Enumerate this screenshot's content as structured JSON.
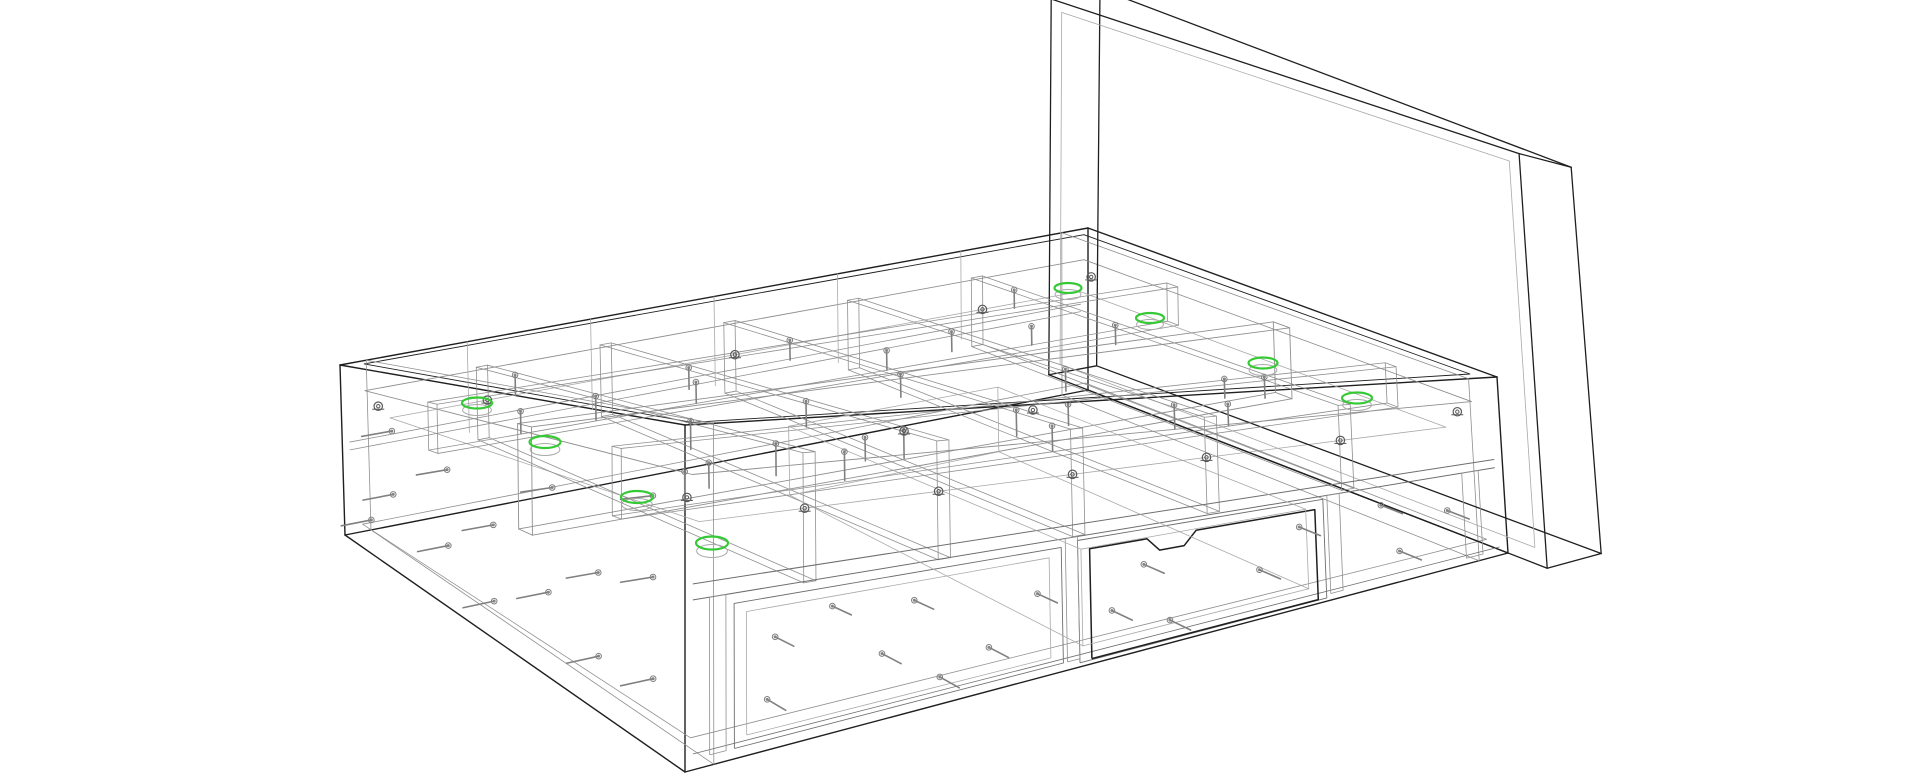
{
  "meta": {
    "title": "storage-bed-assembly-wireframe",
    "description": "CAD wireframe rendering of a platform storage bed with headboard, internal compartment grid, fasteners and one drawer front with handle notch; eight cam-lock positions highlighted in green",
    "background": "#ffffff"
  },
  "palette": {
    "outline_dark": "#1f1f1f",
    "line_mid": "#6e6e6e",
    "line_gray": "#8f8f8f",
    "line_light": "#a9a9a9",
    "fastener_gray": "#808080",
    "cam_gray": "#5a5a5a",
    "highlight_green": "#35c935",
    "highlight_shadow": "#a9a9a9"
  },
  "projection": {
    "L": 200,
    "W": 150,
    "H": 65,
    "lattice": {
      "T00": [
        685,
        425
      ],
      "T10": [
        1497,
        377
      ],
      "T01": [
        340,
        365
      ],
      "T11": [
        1088,
        228
      ],
      "B00": [
        685,
        772
      ],
      "B10": [
        1508,
        553
      ],
      "B01": [
        345,
        535
      ],
      "B11": [
        1088,
        390
      ]
    }
  },
  "parts": [
    {
      "name": "outer-frame",
      "type": "box",
      "color": "#1f1f1f",
      "lw": 1.4,
      "box": [
        0,
        200,
        0,
        150,
        0,
        65
      ]
    },
    {
      "name": "top-rim-inner",
      "type": "rect",
      "color": "#1f1f1f",
      "lw": 0.9,
      "plane": "z",
      "at": 65,
      "a": [
        4,
        196
      ],
      "b": [
        4,
        146
      ]
    },
    {
      "name": "top-rim-lip",
      "type": "rect",
      "color": "#8f8f8f",
      "lw": 0.9,
      "plane": "z",
      "at": 55,
      "a": [
        4,
        196
      ],
      "b": [
        4,
        146
      ]
    },
    {
      "name": "slat-ledge",
      "type": "rect",
      "color": "#a9a9a9",
      "lw": 0.8,
      "plane": "z",
      "at": 45,
      "a": [
        8,
        192
      ],
      "b": [
        8,
        142
      ]
    },
    {
      "name": "bottom-inner-rim",
      "type": "rect",
      "color": "#8f8f8f",
      "lw": 0.8,
      "plane": "z",
      "at": 5,
      "a": [
        3,
        197
      ],
      "b": [
        3,
        147
      ]
    },
    {
      "name": "left-end-inner-panel",
      "type": "rect",
      "color": "#8f8f8f",
      "lw": 0.8,
      "plane": "x",
      "at": 7,
      "a": [
        0,
        150
      ],
      "b": [
        0,
        65
      ]
    },
    {
      "name": "right-end-inner-panel",
      "type": "rect",
      "color": "#8f8f8f",
      "lw": 0.8,
      "plane": "x",
      "at": 193,
      "a": [
        0,
        150
      ],
      "b": [
        0,
        65
      ]
    },
    {
      "name": "headboard",
      "type": "box",
      "color": "#1f1f1f",
      "lw": 1.3,
      "box": [
        200,
        213,
        -14,
        164,
        0,
        152
      ]
    },
    {
      "name": "headboard-inner-face",
      "type": "rect",
      "color": "#a9a9a9",
      "lw": 0.8,
      "plane": "x",
      "at": 200,
      "a": [
        -10,
        160
      ],
      "b": [
        6,
        148
      ]
    },
    {
      "name": "center-beam",
      "type": "box",
      "color": "#8f8f8f",
      "lw": 0.9,
      "box": [
        3,
        197,
        72,
        78,
        30,
        57
      ]
    },
    {
      "name": "front-inner-rail",
      "type": "box",
      "color": "#8f8f8f",
      "lw": 0.8,
      "box": [
        3,
        197,
        33,
        37,
        42,
        57
      ]
    },
    {
      "name": "rear-inner-rail",
      "type": "box",
      "color": "#8f8f8f",
      "lw": 0.8,
      "box": [
        3,
        197,
        113,
        117,
        42,
        57
      ]
    },
    {
      "name": "cross-rib-1",
      "type": "box",
      "color": "#8f8f8f",
      "lw": 0.8,
      "box": [
        32.5,
        35.5,
        6,
        144,
        30,
        57
      ]
    },
    {
      "name": "cross-rib-2",
      "type": "box",
      "color": "#8f8f8f",
      "lw": 0.8,
      "box": [
        65.5,
        68.5,
        6,
        144,
        30,
        57
      ]
    },
    {
      "name": "cross-rib-3",
      "type": "box",
      "color": "#8f8f8f",
      "lw": 0.8,
      "box": [
        98.5,
        101.5,
        6,
        144,
        30,
        57
      ]
    },
    {
      "name": "cross-rib-4",
      "type": "box",
      "color": "#8f8f8f",
      "lw": 0.8,
      "box": [
        131.5,
        134.5,
        6,
        144,
        30,
        57
      ]
    },
    {
      "name": "cross-rib-5",
      "type": "box",
      "color": "#8f8f8f",
      "lw": 0.8,
      "box": [
        164.5,
        167.5,
        6,
        144,
        30,
        57
      ]
    },
    {
      "name": "front-mid-rail-top",
      "type": "line",
      "color": "#6e6e6e",
      "lw": 1.0,
      "line": [
        2,
        0,
        35,
        198,
        0,
        35
      ]
    },
    {
      "name": "front-mid-rail-bottom",
      "type": "line",
      "color": "#6e6e6e",
      "lw": 1.0,
      "line": [
        2,
        0,
        32,
        198,
        0,
        32
      ]
    },
    {
      "name": "rear-mid-rail-top",
      "type": "line",
      "color": "#8f8f8f",
      "lw": 0.8,
      "line": [
        2,
        150,
        35,
        198,
        150,
        35
      ]
    },
    {
      "name": "rear-mid-rail-bottom",
      "type": "line",
      "color": "#8f8f8f",
      "lw": 0.8,
      "line": [
        2,
        150,
        32,
        198,
        150,
        32
      ]
    },
    {
      "name": "front-kick-line",
      "type": "line",
      "color": "#6e6e6e",
      "lw": 0.8,
      "line": [
        2,
        0,
        3,
        198,
        0,
        3
      ]
    },
    {
      "name": "left-drawer-bay",
      "type": "rect",
      "color": "#6e6e6e",
      "lw": 0.9,
      "plane": "y",
      "at": 0,
      "a": [
        12,
        92
      ],
      "b": [
        2,
        30
      ]
    },
    {
      "name": "left-drawer-bay-inner",
      "type": "rect",
      "color": "#a9a9a9",
      "lw": 0.8,
      "plane": "y",
      "at": 0,
      "a": [
        15,
        89
      ],
      "b": [
        4,
        28
      ]
    },
    {
      "name": "right-drawer-opening",
      "type": "rect",
      "color": "#6e6e6e",
      "lw": 0.9,
      "plane": "y",
      "at": 0,
      "a": [
        96,
        156
      ],
      "b": [
        1,
        31
      ]
    },
    {
      "name": "front-stile-left",
      "type": "rect",
      "color": "#8f8f8f",
      "lw": 0.8,
      "plane": "y",
      "at": 0,
      "a": [
        6,
        10
      ],
      "b": [
        2,
        32
      ]
    },
    {
      "name": "front-stile-mid1",
      "type": "rect",
      "color": "#8f8f8f",
      "lw": 0.8,
      "plane": "y",
      "at": 0,
      "a": [
        93,
        96
      ],
      "b": [
        2,
        32
      ]
    },
    {
      "name": "front-stile-mid2",
      "type": "rect",
      "color": "#8f8f8f",
      "lw": 0.8,
      "plane": "y",
      "at": 0,
      "a": [
        157,
        160
      ],
      "b": [
        2,
        32
      ]
    },
    {
      "name": "front-stile-right",
      "type": "rect",
      "color": "#8f8f8f",
      "lw": 0.8,
      "plane": "y",
      "at": 0,
      "a": [
        190,
        194
      ],
      "b": [
        2,
        32
      ]
    },
    {
      "name": "drawer-front-outline",
      "type": "path_y",
      "color": "#1f1f1f",
      "lw": 1.5,
      "y": -1.5,
      "pts": [
        [
          98,
          2
        ],
        [
          153,
          2
        ],
        [
          153,
          29
        ],
        [
          124,
          29
        ],
        [
          121,
          25.5
        ],
        [
          115,
          25.5
        ],
        [
          112,
          29
        ],
        [
          98,
          29
        ],
        [
          98,
          2
        ]
      ]
    },
    {
      "name": "drawer-box",
      "type": "box",
      "color": "#a9a9a9",
      "lw": 0.8,
      "box": [
        98,
        153,
        2,
        118,
        4,
        28
      ]
    },
    {
      "name": "rear-rib-vertical-1",
      "type": "line",
      "color": "#a9a9a9",
      "lw": 0.8,
      "line": [
        34,
        150,
        30,
        34,
        150,
        65
      ]
    },
    {
      "name": "rear-rib-vertical-2",
      "type": "line",
      "color": "#a9a9a9",
      "lw": 0.8,
      "line": [
        67,
        150,
        30,
        67,
        150,
        65
      ]
    },
    {
      "name": "rear-rib-vertical-3",
      "type": "line",
      "color": "#a9a9a9",
      "lw": 0.8,
      "line": [
        100,
        150,
        30,
        100,
        150,
        65
      ]
    },
    {
      "name": "rear-rib-vertical-4",
      "type": "line",
      "color": "#a9a9a9",
      "lw": 0.8,
      "line": [
        133,
        150,
        30,
        133,
        150,
        65
      ]
    },
    {
      "name": "rear-rib-vertical-5",
      "type": "line",
      "color": "#a9a9a9",
      "lw": 0.8,
      "line": [
        166,
        150,
        30,
        166,
        150,
        65
      ]
    }
  ],
  "fasteners": {
    "color": "#808080",
    "items": [
      {
        "p": [
          20,
          0,
          10
        ],
        "a": "y"
      },
      {
        "p": [
          22,
          0,
          22
        ],
        "a": "y"
      },
      {
        "p": [
          48,
          0,
          14
        ],
        "a": "y"
      },
      {
        "p": [
          56,
          0,
          24
        ],
        "a": "y"
      },
      {
        "p": [
          74,
          0,
          10
        ],
        "a": "y"
      },
      {
        "p": [
          86,
          0,
          20
        ],
        "a": "y"
      },
      {
        "p": [
          104,
          0,
          12
        ],
        "a": "y"
      },
      {
        "p": [
          112,
          0,
          22
        ],
        "a": "y"
      },
      {
        "p": [
          140,
          0,
          14
        ],
        "a": "y"
      },
      {
        "p": [
          150,
          0,
          24
        ],
        "a": "y"
      },
      {
        "p": [
          174,
          0,
          10
        ],
        "a": "y"
      },
      {
        "p": [
          186,
          0,
          20
        ],
        "a": "y"
      },
      {
        "p": [
          36,
          0,
          26
        ],
        "a": "y"
      },
      {
        "p": [
          62,
          0,
          6
        ],
        "a": "y"
      },
      {
        "p": [
          118,
          0,
          6
        ],
        "a": "y"
      },
      {
        "p": [
          170,
          0,
          26
        ],
        "a": "y"
      },
      {
        "p": [
          0,
          14,
          14
        ],
        "a": "x"
      },
      {
        "p": [
          0,
          14,
          34
        ],
        "a": "x"
      },
      {
        "p": [
          0,
          14,
          50
        ],
        "a": "x"
      },
      {
        "p": [
          0,
          38,
          12
        ],
        "a": "x"
      },
      {
        "p": [
          0,
          38,
          30
        ],
        "a": "x"
      },
      {
        "p": [
          0,
          58,
          45
        ],
        "a": "x"
      },
      {
        "p": [
          0,
          60,
          20
        ],
        "a": "x"
      },
      {
        "p": [
          0,
          84,
          30
        ],
        "a": "x"
      },
      {
        "p": [
          0,
          84,
          10
        ],
        "a": "x"
      },
      {
        "p": [
          0,
          104,
          40
        ],
        "a": "x"
      },
      {
        "p": [
          0,
          104,
          18
        ],
        "a": "x"
      },
      {
        "p": [
          0,
          128,
          25
        ],
        "a": "x"
      },
      {
        "p": [
          0,
          128,
          46
        ],
        "a": "x"
      },
      {
        "p": [
          0,
          138,
          12
        ],
        "a": "x"
      },
      {
        "p": [
          34,
          20,
          57
        ],
        "a": "z"
      },
      {
        "p": [
          34,
          56,
          57
        ],
        "a": "z"
      },
      {
        "p": [
          34,
          96,
          57
        ],
        "a": "z"
      },
      {
        "p": [
          34,
          130,
          57
        ],
        "a": "z"
      },
      {
        "p": [
          67,
          22,
          57
        ],
        "a": "z"
      },
      {
        "p": [
          67,
          62,
          57
        ],
        "a": "z"
      },
      {
        "p": [
          67,
          110,
          57
        ],
        "a": "z"
      },
      {
        "p": [
          100,
          30,
          57
        ],
        "a": "z"
      },
      {
        "p": [
          100,
          76,
          57
        ],
        "a": "z"
      },
      {
        "p": [
          100,
          120,
          57
        ],
        "a": "z"
      },
      {
        "p": [
          133,
          20,
          57
        ],
        "a": "z"
      },
      {
        "p": [
          133,
          62,
          57
        ],
        "a": "z"
      },
      {
        "p": [
          133,
          106,
          57
        ],
        "a": "z"
      },
      {
        "p": [
          166,
          36,
          57
        ],
        "a": "z"
      },
      {
        "p": [
          166,
          92,
          57
        ],
        "a": "z"
      },
      {
        "p": [
          166,
          130,
          57
        ],
        "a": "z"
      },
      {
        "p": [
          50,
          75,
          40
        ],
        "a": "z"
      },
      {
        "p": [
          90,
          75,
          40
        ],
        "a": "z"
      },
      {
        "p": [
          142,
          75,
          40
        ],
        "a": "z"
      },
      {
        "p": [
          182,
          75,
          40
        ],
        "a": "z"
      },
      {
        "p": [
          20,
          35,
          50
        ],
        "a": "z"
      },
      {
        "p": [
          60,
          35,
          50
        ],
        "a": "z"
      },
      {
        "p": [
          112,
          35,
          50
        ],
        "a": "z"
      },
      {
        "p": [
          156,
          35,
          50
        ],
        "a": "z"
      },
      {
        "p": [
          26,
          115,
          50
        ],
        "a": "z"
      },
      {
        "p": [
          72,
          115,
          50
        ],
        "a": "z"
      },
      {
        "p": [
          122,
          115,
          50
        ],
        "a": "z"
      },
      {
        "p": [
          160,
          115,
          50
        ],
        "a": "z"
      }
    ]
  },
  "cam_locks": {
    "color": "#5a5a5a",
    "items": [
      [
        34,
        8,
        45
      ],
      [
        67,
        8,
        45
      ],
      [
        100,
        8,
        45
      ],
      [
        133,
        8,
        45
      ],
      [
        166,
        8,
        45
      ],
      [
        34,
        142,
        45
      ],
      [
        100,
        142,
        45
      ],
      [
        166,
        142,
        45
      ],
      [
        5,
        8,
        50
      ],
      [
        195,
        8,
        50
      ],
      [
        5,
        142,
        50
      ],
      [
        195,
        142,
        50
      ],
      [
        100,
        75,
        40
      ],
      [
        133,
        75,
        40
      ]
    ]
  },
  "highlights": {
    "color": "#35c935",
    "shadow": "#a9a9a9",
    "items": [
      {
        "cx": 477,
        "cy": 403,
        "rx": 15,
        "ry": 5.5
      },
      {
        "cx": 545,
        "cy": 442,
        "rx": 15.5,
        "ry": 6
      },
      {
        "cx": 637,
        "cy": 497,
        "rx": 16,
        "ry": 6
      },
      {
        "cx": 712,
        "cy": 543,
        "rx": 16,
        "ry": 6.5
      },
      {
        "cx": 1068,
        "cy": 288,
        "rx": 13.5,
        "ry": 5
      },
      {
        "cx": 1150,
        "cy": 318,
        "rx": 14,
        "ry": 5
      },
      {
        "cx": 1263,
        "cy": 363,
        "rx": 14.5,
        "ry": 5.5
      },
      {
        "cx": 1357,
        "cy": 398,
        "rx": 15,
        "ry": 5.5
      }
    ]
  }
}
